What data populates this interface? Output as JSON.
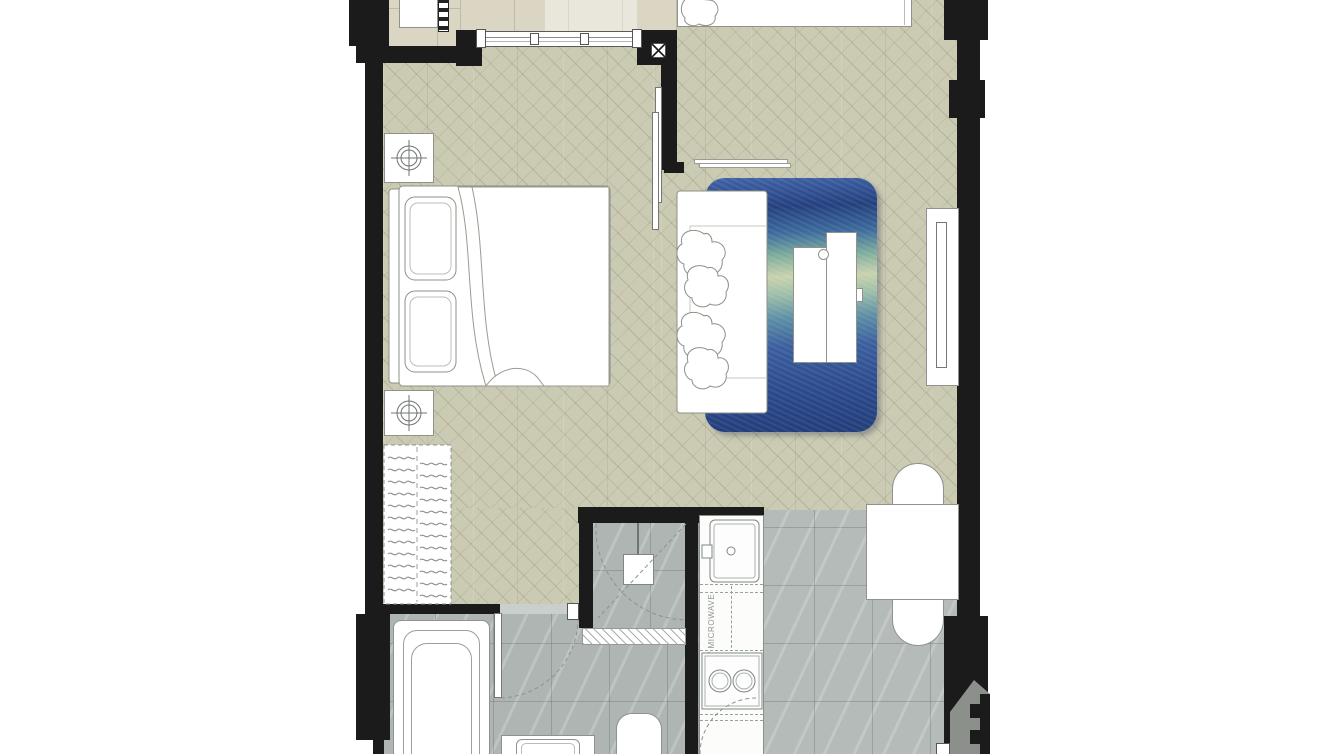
{
  "floorplan": {
    "title": "one-bedroom-condo-unit-floor-plan",
    "labels": {
      "kitchen_counter": "W/ MICROWAVE"
    },
    "rooms": [
      "balcony",
      "bedroom",
      "living-area",
      "kitchen",
      "bathroom",
      "shower",
      "dining-entry-hall"
    ],
    "fixtures": [
      "air-conditioner-unit",
      "balcony-rack",
      "sliding-window",
      "double-bed",
      "pillows",
      "nightstand-with-lamp",
      "nightstand-with-lamp",
      "wardrobe-with-hangers",
      "sliding-partition-door",
      "wall-shelf",
      "sofa-with-cushions",
      "area-rug",
      "coffee-table",
      "tv-console",
      "dining-table",
      "dining-chair",
      "dining-chair",
      "kitchen-sink",
      "two-burner-stove",
      "microwave-counter",
      "shower-head",
      "shower-screen-swing",
      "bathroom-door-swing",
      "bathtub",
      "vanity-washbasin",
      "toilet",
      "entrance-door-swing",
      "shaft-symbol"
    ],
    "colors": {
      "wall": "#1b1b1b",
      "wood_floor": "#cbcab3",
      "balcony_tile": "#dbd5c3",
      "bath_tile": "#b4bbb9",
      "rug_navy": "#24407e",
      "rug_teal": "#7fae9d",
      "rug_cream": "#c9d2ae",
      "furniture_outline": "#8f938b",
      "watermark_gray": "#8b908b"
    },
    "watermark": "arrow-house-logo-fragment"
  }
}
